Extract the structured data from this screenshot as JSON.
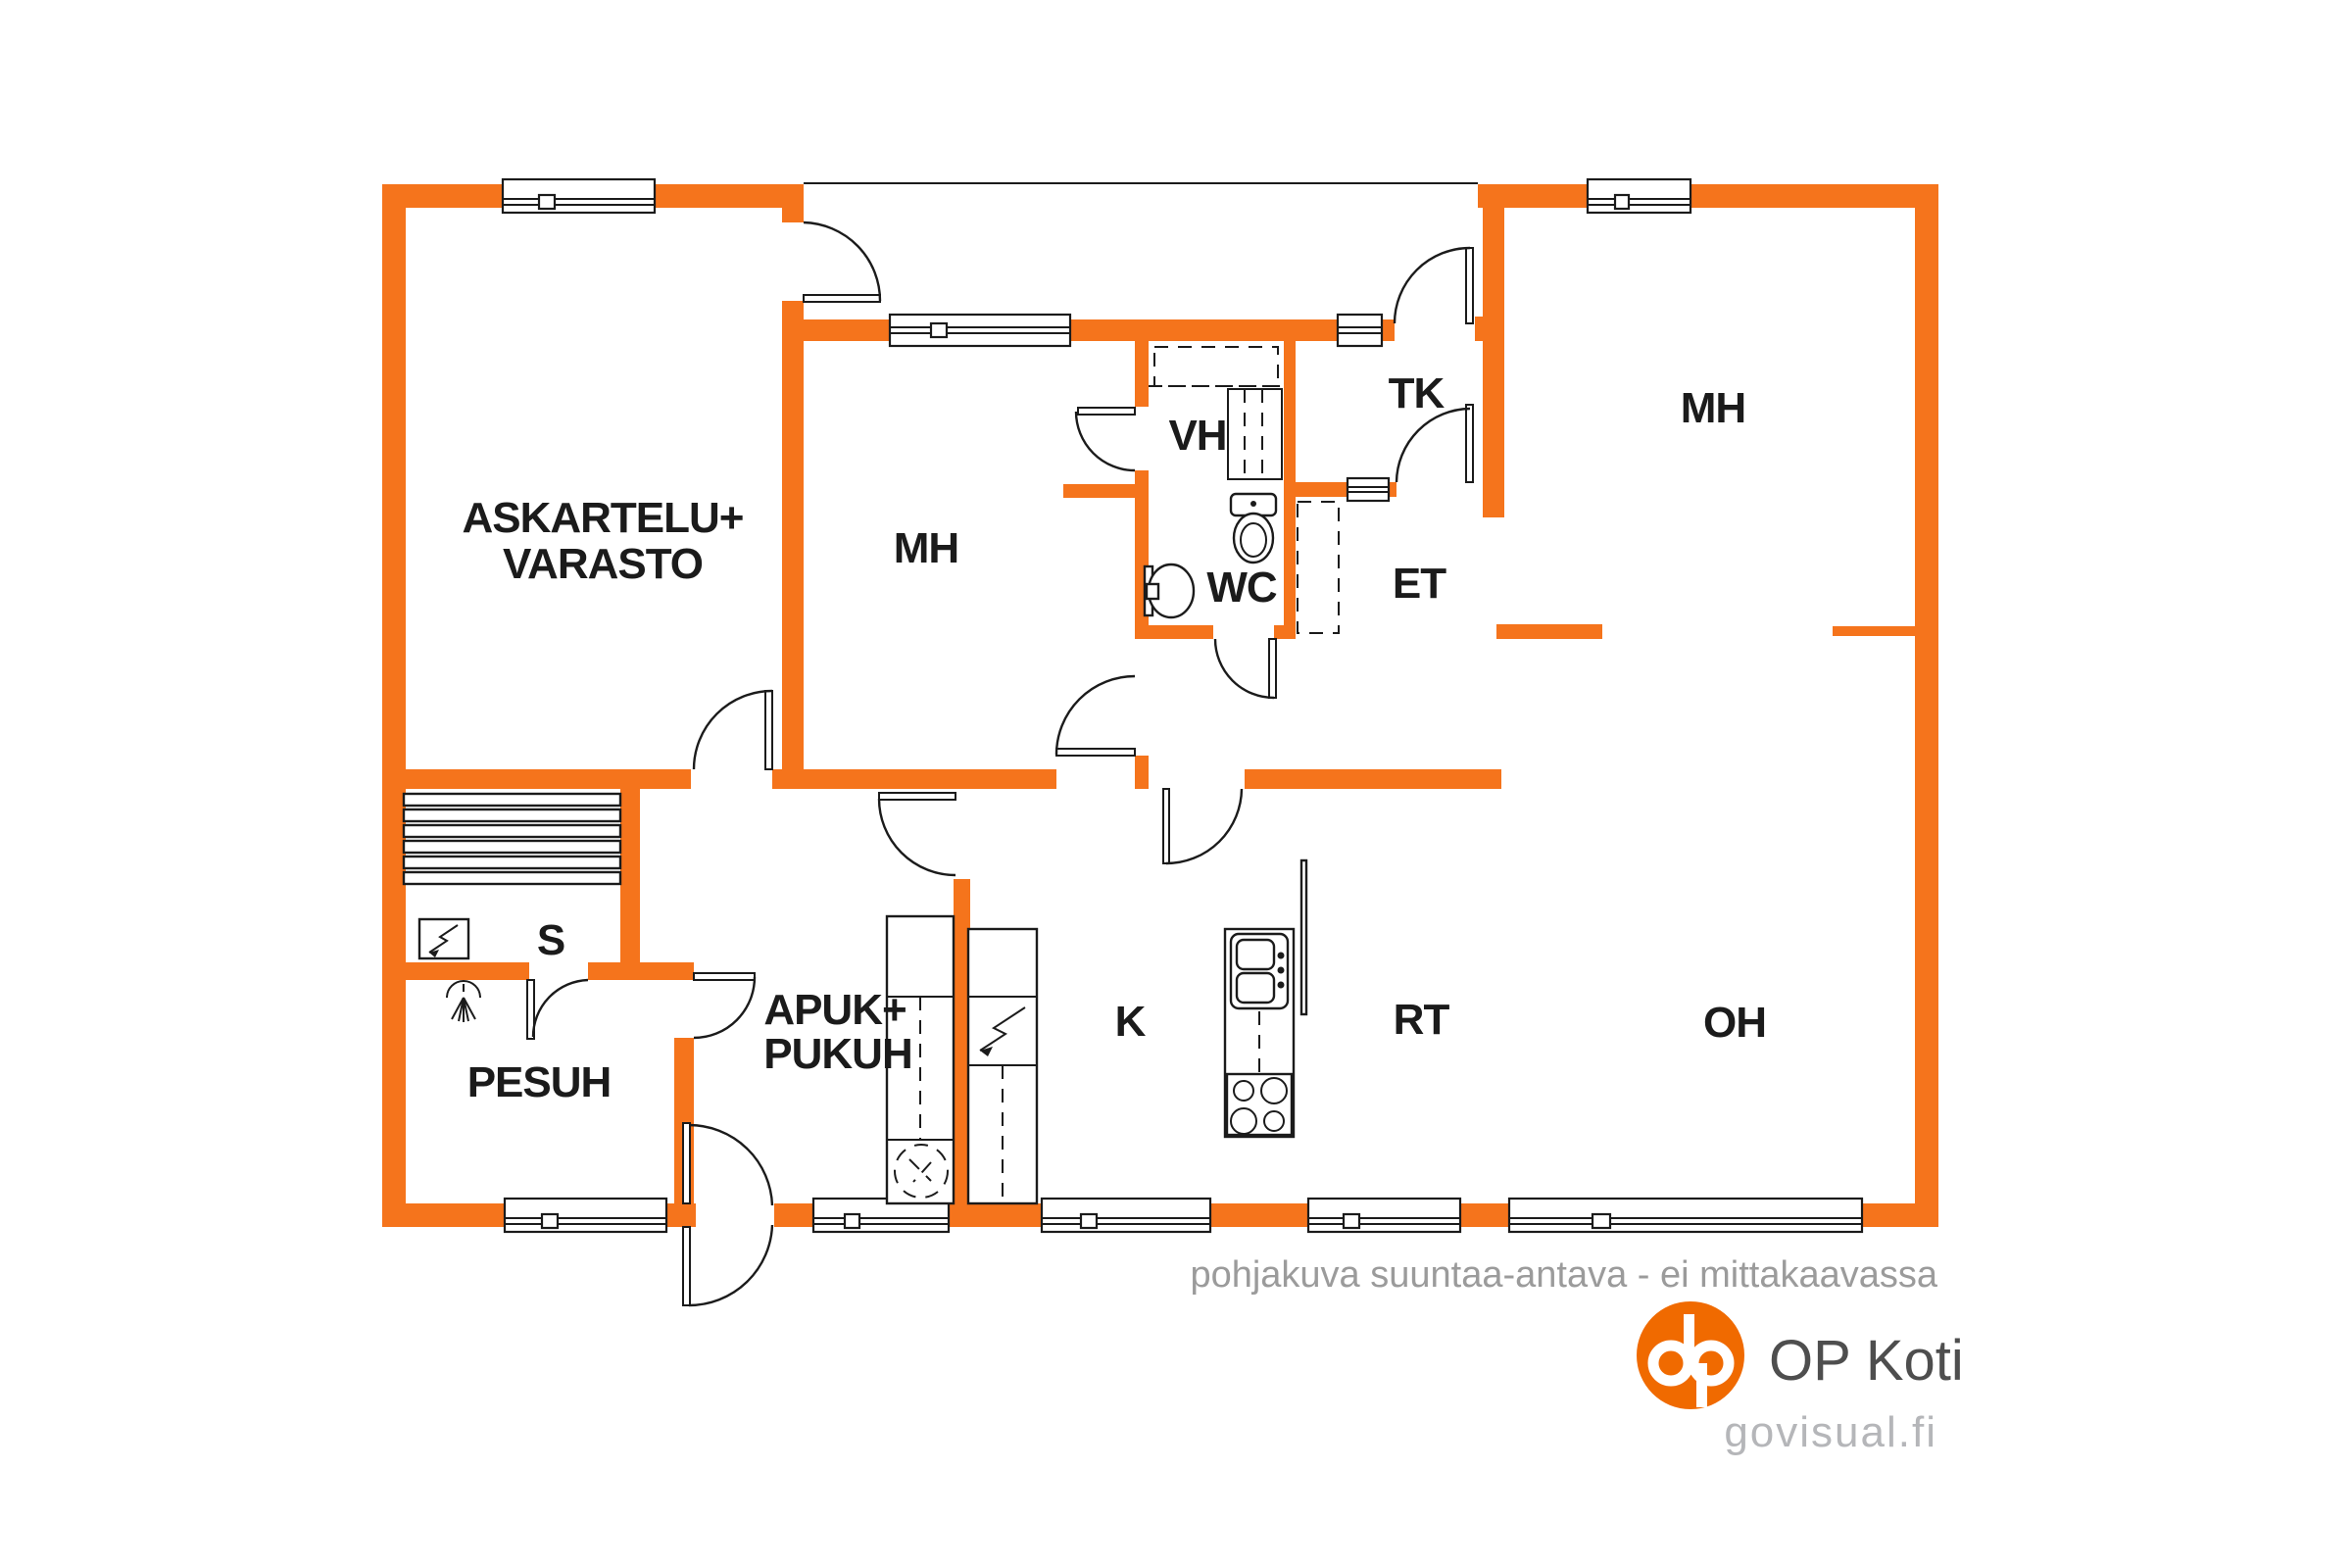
{
  "title": "floor plan",
  "colors": {
    "wall": "#F5741C",
    "line": "#1b1b1b",
    "label": "#1b1b1b",
    "disclaimer": "#9b9b9b",
    "brand": "#4e4e4e",
    "url": "#b5b6b9",
    "logo": "#F06A00"
  },
  "rooms": {
    "askartelu_line1": "ASKARTELU+",
    "askartelu_line2": "VARASTO",
    "mh_left": "MH",
    "vh": "VH",
    "tk": "TK",
    "mh_right": "MH",
    "wc": "WC",
    "et": "ET",
    "s": "S",
    "pesuh": "PESUH",
    "apuk_line1": "APUK+",
    "apuk_line2": "PUKUH",
    "k": "K",
    "rt": "RT",
    "oh": "OH"
  },
  "footer": {
    "disclaimer": "pohjakuva suuntaa-antava - ei mittakaavassa",
    "brand": "OP Koti",
    "url": "govisual.fi"
  },
  "icons": [
    "toilet-icon",
    "sink-icon",
    "shower-icon",
    "sauna-stove-icon",
    "sauna-benches-icon",
    "electric-stove-icon",
    "kitchen-sink-icon",
    "hob-icon",
    "washing-machine-icon",
    "op-logo"
  ]
}
